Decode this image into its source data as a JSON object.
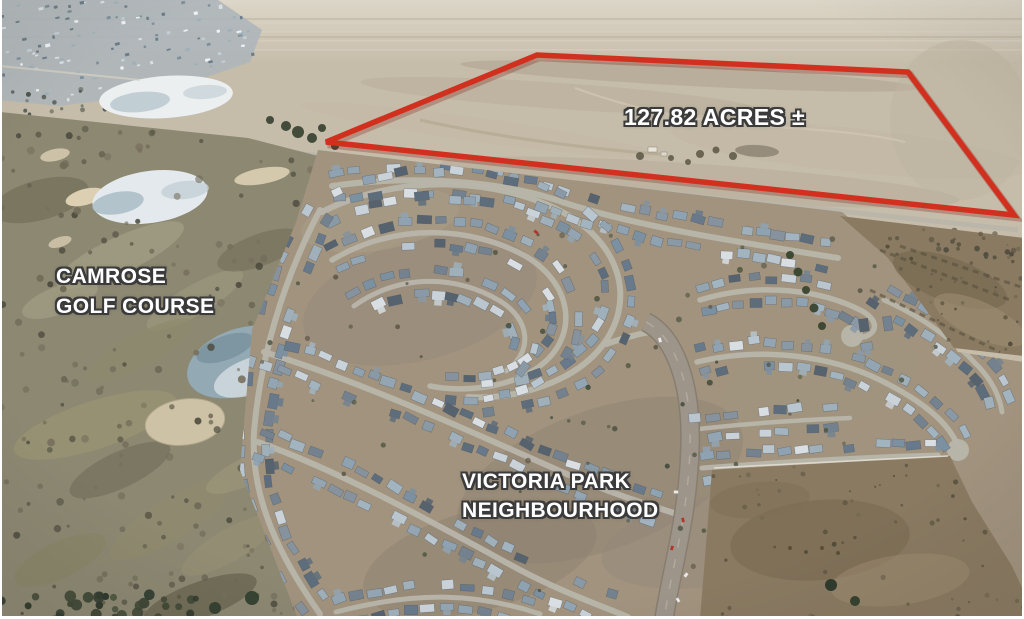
{
  "photo": {
    "description_visible": "aerial photograph of farmland parcel outlined in red beside a golf course and residential neighbourhood"
  },
  "parcel": {
    "acreage_text": "127.82 ACRES ±",
    "outline_points": "326,142 537,55 908,72 1014,215",
    "outline_color": "#d2301f"
  },
  "areas": {
    "golf_course": {
      "line1": "CAMROSE",
      "line2": "GOLF COURSE"
    },
    "neighbourhood": {
      "line1": "VICTORIA PARK",
      "line2": "NEIGHBOURHOOD"
    }
  },
  "label_style": {
    "text_color": "#ffffff",
    "outline_color": "#3b3b3b"
  }
}
